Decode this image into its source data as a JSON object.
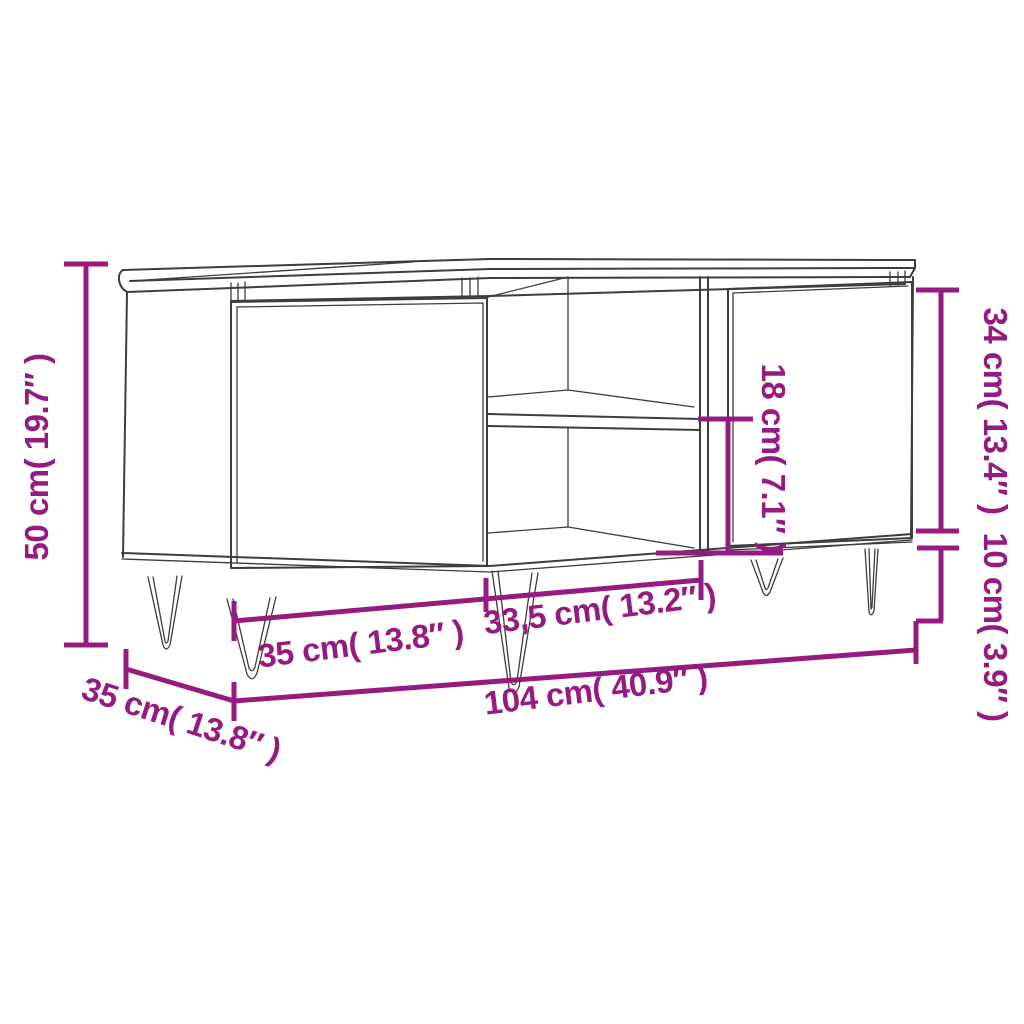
{
  "diagram": {
    "colors": {
      "dimension_accent": "#951b81",
      "line_art": "#3d3d3d",
      "background": "#ffffff"
    },
    "dimensions": {
      "overall_height": {
        "label": "50 cm( 19.7″ )",
        "cm": "50",
        "inches": "19.7"
      },
      "depth": {
        "label": "35 cm( 13.8″ )",
        "cm": "35",
        "inches": "13.8"
      },
      "left_door_width": {
        "label": "35 cm( 13.8″ )",
        "cm": "35",
        "inches": "13.8"
      },
      "middle_section_width": {
        "label": "33,5 cm( 13.2″ )",
        "cm": "33,5",
        "inches": "13.2"
      },
      "overall_width": {
        "label": "104 cm( 40.9″ )",
        "cm": "104",
        "inches": "40.9"
      },
      "door_height": {
        "label": "34 cm( 13.4″ )",
        "cm": "34",
        "inches": "13.4"
      },
      "leg_height": {
        "label": "10 cm( 3.9″ )",
        "cm": "10",
        "inches": "3.9"
      },
      "shelf_opening_height": {
        "label": "18 cm( 7.1″ )",
        "cm": "18",
        "inches": "7.1"
      }
    }
  }
}
